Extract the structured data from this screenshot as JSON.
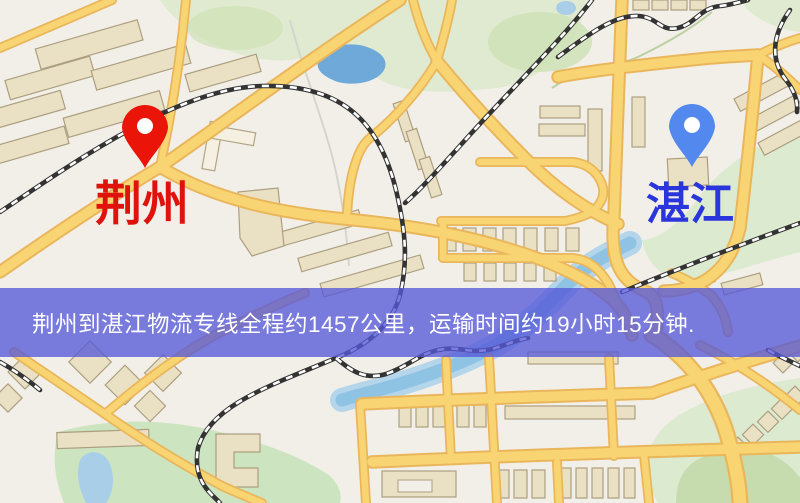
{
  "map": {
    "origin": {
      "label": "荆州",
      "label_color": "#e0120c",
      "pin_color": "#ea1408",
      "pin_icon": "red-map-pin"
    },
    "destination": {
      "label": "湛江",
      "label_color": "#2a36dc",
      "pin_color": "#5389ef",
      "pin_icon": "blue-map-pin"
    },
    "palette": {
      "land": "#f2efe8",
      "road_fill": "#f8d572",
      "road_border": "#eab65c",
      "park_green": "#dfead0",
      "dark_green": "#cfe2b6",
      "water_blue": "#7fb0dd",
      "river_blue": "#8fc3e3",
      "railway_dark": "#333333",
      "building_tan": "#eae1c4"
    }
  },
  "banner": {
    "text": "荆州到湛江物流专线全程约1457公里，运输时间约19小时15分钟.",
    "background_hex": "#5658d8",
    "background_opacity": "0.78",
    "text_color": "#ffffff"
  }
}
